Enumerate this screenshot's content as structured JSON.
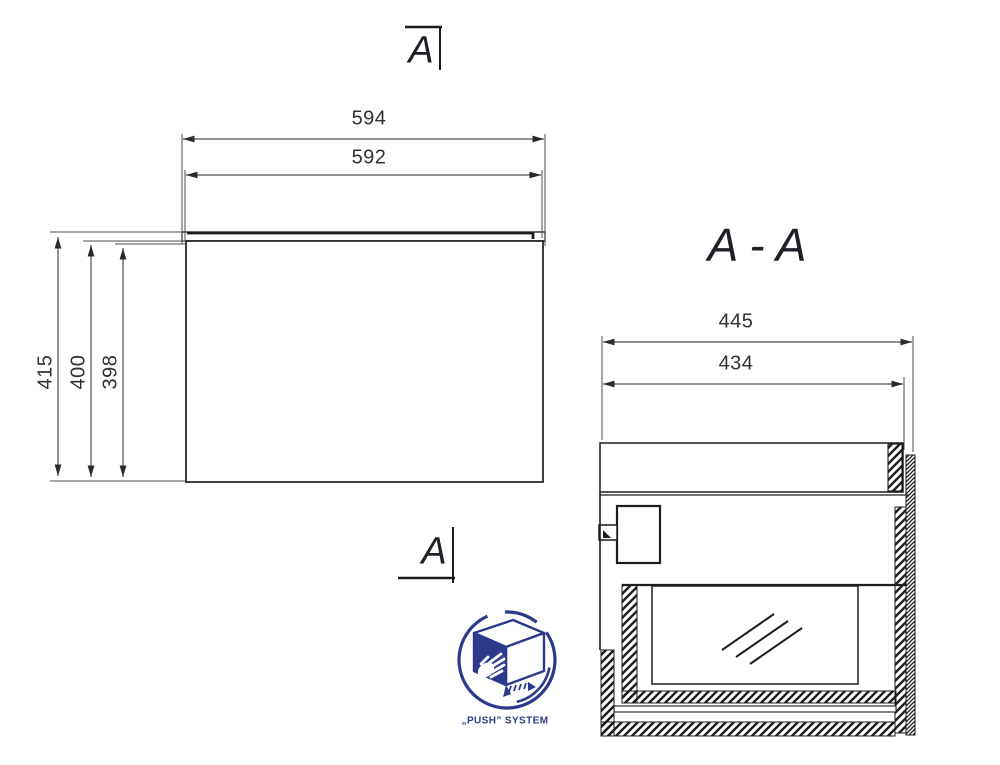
{
  "drawing": {
    "front_view": {
      "width_top": "594",
      "width_cabinet": "592",
      "height_total": "415",
      "height_mid": "400",
      "height_inner": "398"
    },
    "section_view": {
      "title": "A - A",
      "depth_total": "445",
      "depth_inner": "434"
    },
    "cut_marker_top": "A",
    "cut_marker_bottom": "A",
    "logo_label": "„PUSH” SYSTEM",
    "colors": {
      "line": "#1c1c1c",
      "dimension": "#4d4d4d",
      "accent_navy": "#2d3a8c"
    }
  }
}
